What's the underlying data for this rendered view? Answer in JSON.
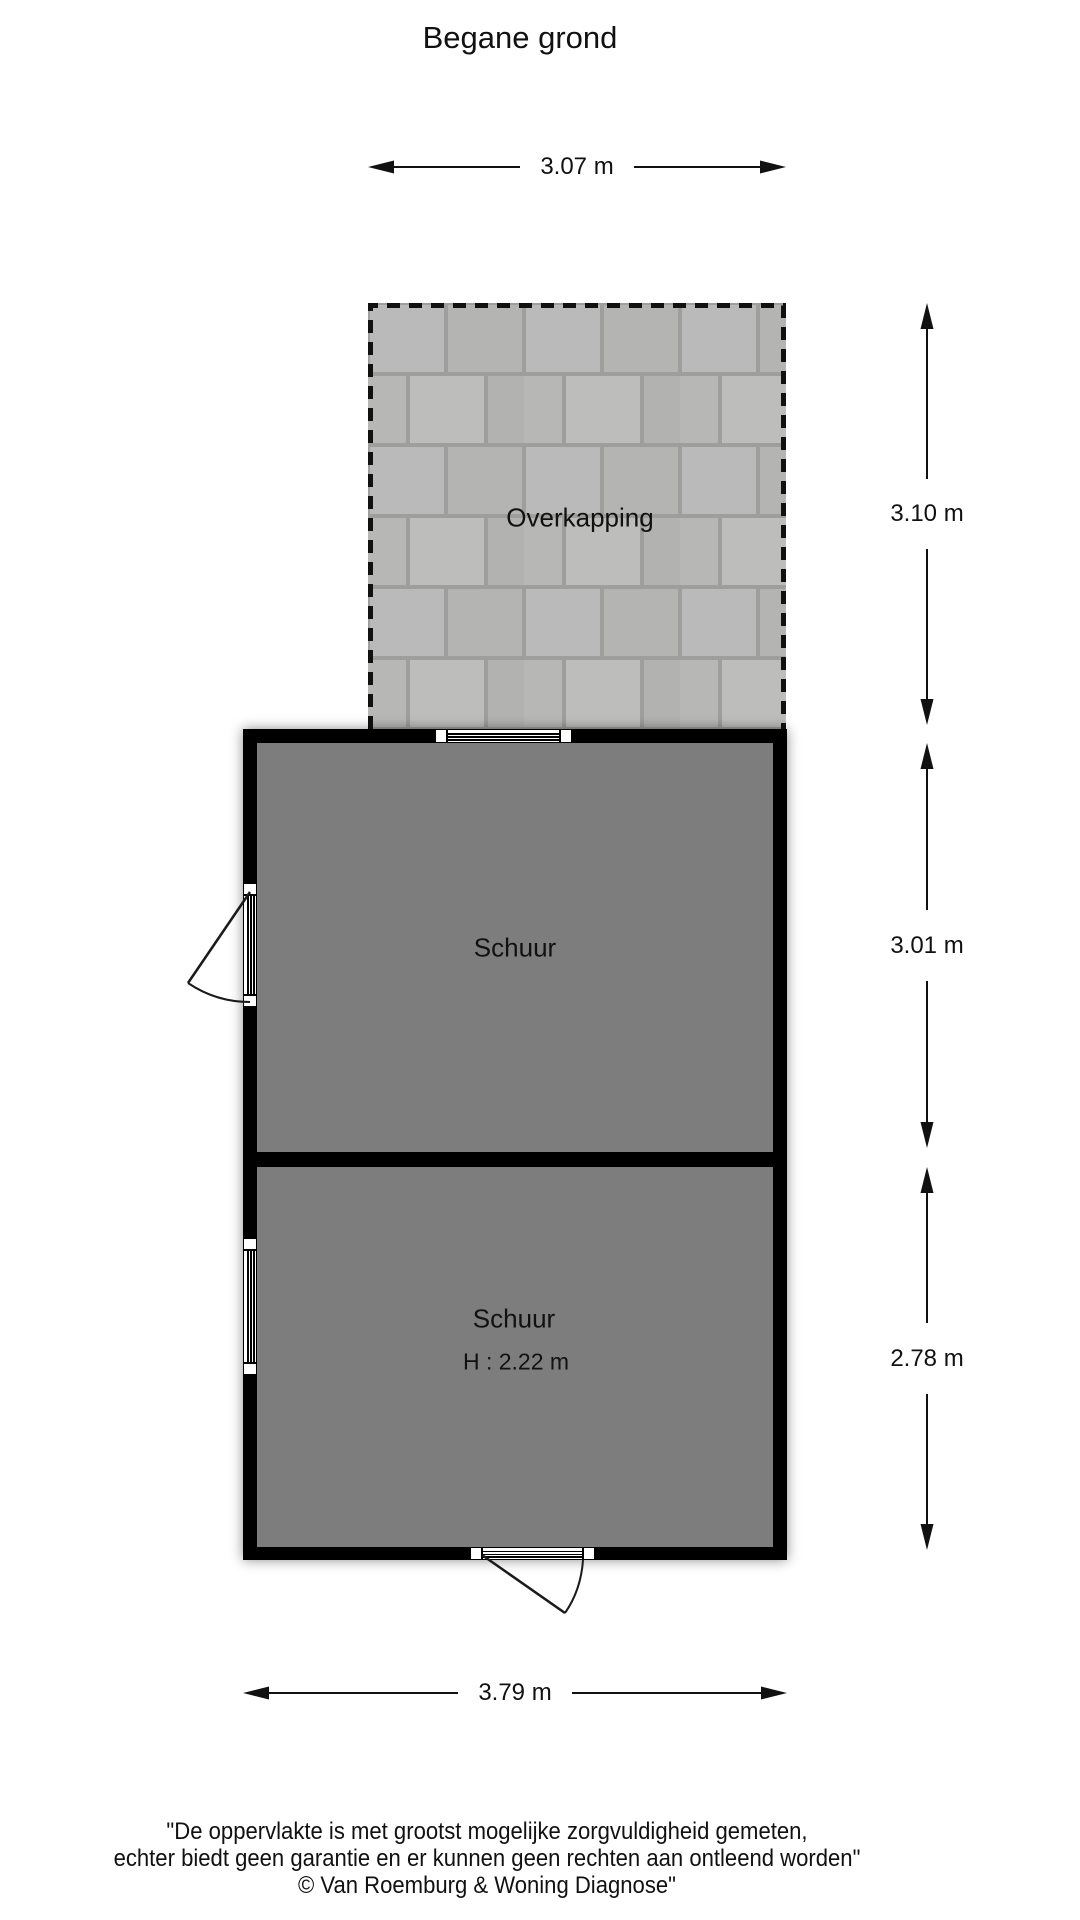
{
  "title": "Begane grond",
  "plan": {
    "overkapping": {
      "label": "Overkapping"
    },
    "schuur_upper": {
      "label": "Schuur"
    },
    "schuur_lower": {
      "label": "Schuur",
      "height_note": "H : 2.22 m"
    },
    "dimensions": {
      "top_width": "3.07 m",
      "right_overkapping_depth": "3.10 m",
      "right_schuur_upper_depth": "3.01 m",
      "right_schuur_lower_depth": "2.78 m",
      "bottom_width": "3.79 m"
    }
  },
  "footer": {
    "line1": "\"De oppervlakte is met grootst mogelijke zorgvuldigheid gemeten,",
    "line2": "echter biedt geen garantie en er kunnen geen rechten aan ontleend worden\"",
    "line3": "© Van Roemburg & Woning Diagnose\""
  },
  "colors": {
    "wall": "#000000",
    "room_fill": "#7d7d7d",
    "tile_fill": "#b9b9b7",
    "tile_grout": "#9e9e9c",
    "background": "#ffffff",
    "text": "#111111"
  }
}
